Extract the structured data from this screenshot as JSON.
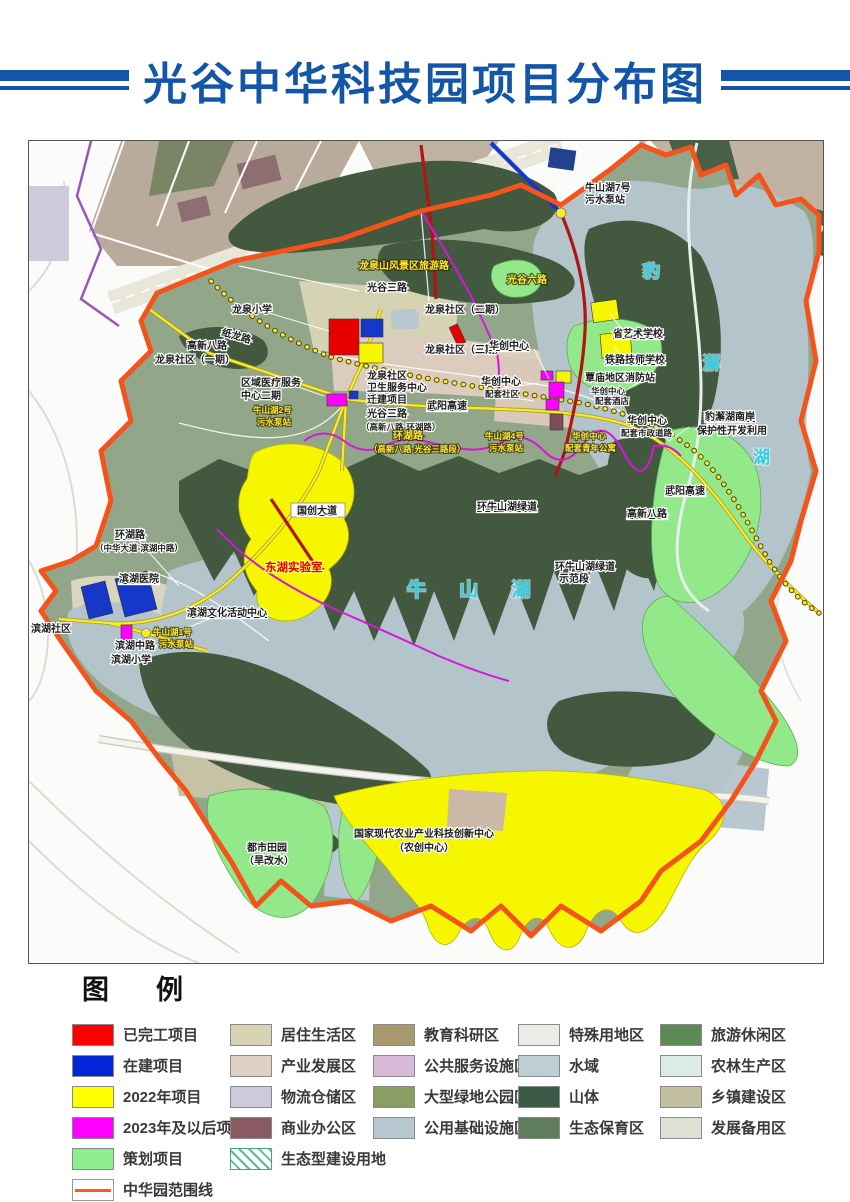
{
  "header": {
    "title": "光谷中华科技园项目分布图"
  },
  "map": {
    "lakes": {
      "niushan": "牛  山  湖",
      "baoxie_1": "豹",
      "baoxie_2": "澥",
      "baoxie_3": "湖"
    },
    "labels": {
      "pump7_1": "牛山湖7号",
      "pump7_2": "污水泵站",
      "scenic_road": "龙泉山风景区旅游路",
      "guanggu6": "光谷六路",
      "guanggu3": "光谷三路",
      "longquan_primary": "龙泉小学",
      "zhilong_road": "纸龙路",
      "lq_phase2": "龙泉社区（二期）",
      "lq_phase3": "龙泉社区（三期）",
      "lq_phase1": "龙泉社区（一期）",
      "gaoxin8_w": "高新八路",
      "medical_1": "区域医疗服务",
      "medical_2": "中心二期",
      "pump2_1": "牛山湖2号",
      "pump2_2": "污水泵站",
      "hygiene_1": "龙泉社区",
      "hygiene_2": "卫生服务中心",
      "hygiene_3": "迁建项目",
      "guanggu3_mid_1": "光谷三路",
      "guanggu3_mid_2": "（高新八路-环湖路）",
      "wuyang_mid": "武阳高速",
      "huachuang": "华创中心",
      "huachuang_comm_1": "华创中心",
      "huachuang_comm_2": "配套社区",
      "art_school": "省艺术学校",
      "railway_school": "铁路技师学校",
      "fire_station": "覃庙地区消防站",
      "hotel_1": "华创中心",
      "hotel_2": "配套酒店",
      "muni_road_1": "华创中心",
      "muni_road_2": "配套市政道路",
      "baoxie_south_1": "豹澥湖南岸",
      "baoxie_south_2": "保护性开发利用",
      "wuyang_se": "武阳高速",
      "gaoxin8_se": "高新八路",
      "greenway": "环牛山湖绿道",
      "huanhu_mid_1": "环湖路",
      "huanhu_mid_2": "（高新八路-光谷三路段）",
      "pump4_1": "牛山湖4号",
      "pump4_2": "污水泵站",
      "youth_1": "华创中心",
      "youth_2": "配套青年公寓",
      "guochuang": "国创大道",
      "donghu_lab": "东湖实验室",
      "greenway_demo_1": "环牛山湖绿道",
      "greenway_demo_2": "示范段",
      "huanhu_w_1": "环湖路",
      "huanhu_w_2": "（中华大道-滨湖中路）",
      "binhu_hospital": "滨湖医院",
      "binhu_community": "滨湖社区",
      "binhu_culture": "滨湖文化活动中心",
      "pump1_1": "牛山湖1号",
      "pump1_2": "污水泵站",
      "binhu_mid_road": "滨湖中路",
      "binhu_primary": "滨湖小学",
      "garden_1": "都市田园",
      "garden_2": "（旱改水）",
      "agri_1": "国家现代农业产业科技创新中心",
      "agri_2": "（农创中心）"
    }
  },
  "legend": {
    "title": "图　例",
    "columns": [
      {
        "items": [
          {
            "label": "已完工项目",
            "color": "#ff0000",
            "kind": "fill"
          },
          {
            "label": "在建项目",
            "color": "#0026d8",
            "kind": "fill"
          },
          {
            "label": "2022年项目",
            "color": "#ffff00",
            "kind": "fill"
          },
          {
            "label": "2023年及以后项目",
            "color": "#ff00ff",
            "kind": "fill"
          },
          {
            "label": "策划项目",
            "color": "#90ee90",
            "kind": "fill"
          },
          {
            "label": "中华园范围线",
            "color": "#ff5a1e",
            "kind": "line"
          }
        ]
      },
      {
        "items": [
          {
            "label": "居住生活区",
            "color": "#d6d4b2",
            "kind": "fill"
          },
          {
            "label": "产业发展区",
            "color": "#ded0c5",
            "kind": "fill"
          },
          {
            "label": "物流仓储区",
            "color": "#cfc9de",
            "kind": "fill"
          },
          {
            "label": "商业办公区",
            "color": "#8a5a64",
            "kind": "fill"
          },
          {
            "label": "生态型建设用地",
            "color": "#4fbf86",
            "kind": "hatch"
          }
        ]
      },
      {
        "items": [
          {
            "label": "教育科研区",
            "color": "#a89a6e",
            "kind": "fill"
          },
          {
            "label": "公共服务设施区",
            "color": "#d6bad8",
            "kind": "fill"
          },
          {
            "label": "大型绿地公园区",
            "color": "#8a9d64",
            "kind": "fill"
          },
          {
            "label": "公用基础设施区",
            "color": "#b7c7cf",
            "kind": "fill"
          }
        ]
      },
      {
        "items": [
          {
            "label": "特殊用地区",
            "color": "#eaece7",
            "kind": "fill"
          },
          {
            "label": "水域",
            "color": "#bfced5",
            "kind": "fill"
          },
          {
            "label": "山体",
            "color": "#3c5846",
            "kind": "fill"
          },
          {
            "label": "生态保育区",
            "color": "#5f7d5c",
            "kind": "fill"
          }
        ]
      },
      {
        "items": [
          {
            "label": "旅游休闲区",
            "color": "#5d8a55",
            "kind": "fill"
          },
          {
            "label": "农林生产区",
            "color": "#dcebe3",
            "kind": "fill"
          },
          {
            "label": "乡镇建设区",
            "color": "#c3bfa2",
            "kind": "fill"
          },
          {
            "label": "发展备用区",
            "color": "#dee1d4",
            "kind": "fill"
          }
        ]
      }
    ]
  }
}
